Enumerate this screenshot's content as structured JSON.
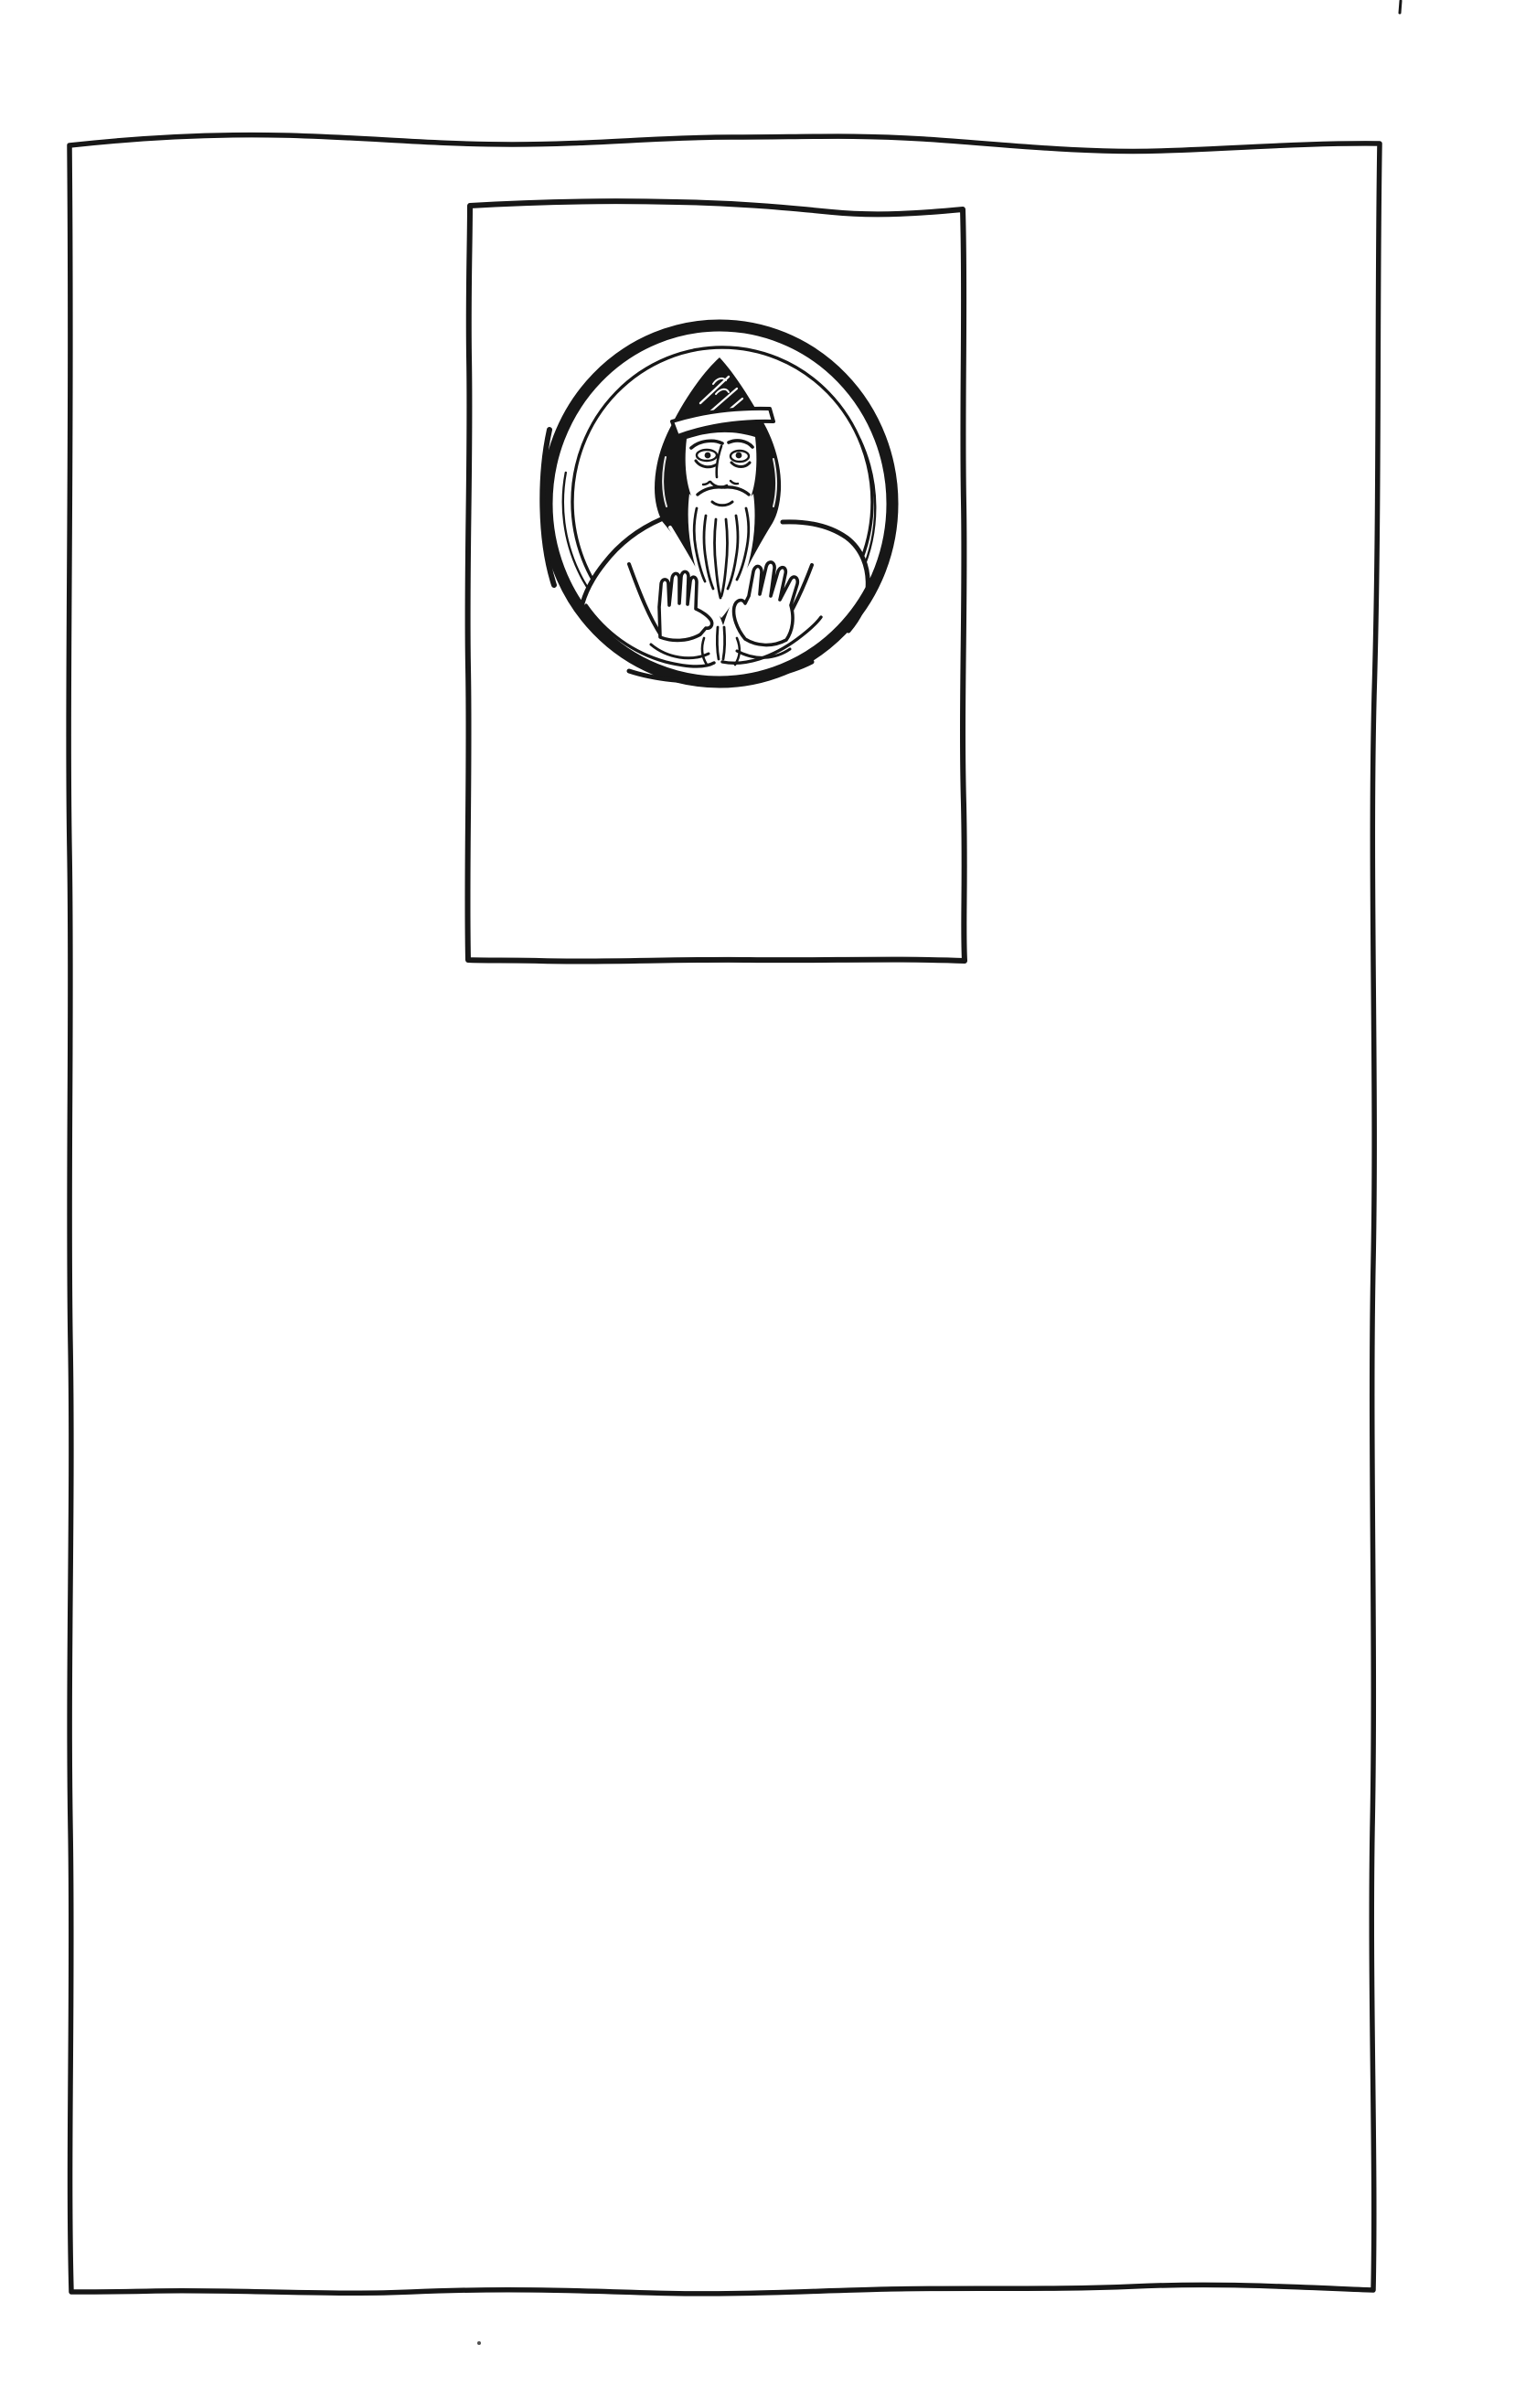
{
  "document": {
    "type": "scanned hand-inked book plate",
    "visible_text": "",
    "description": "Hand-inked page: a large wobbly rectangular border drawn around the whole sheet; in the upper middle an inner hand-drawn rectangular panel contains a double-ringed circular medallion portrait of a bearded man wearing a pointed hood, both palms raised outward."
  },
  "colors": {
    "ink": "#171717",
    "paper": "#ffffff"
  },
  "frame": {
    "outer_border": "hand-drawn wobbly rectangle around full page",
    "plate_panel": "hand-drawn rectangle in upper middle of page"
  },
  "medallion": {
    "subject": "Bearded man in pointed hood with raised palms",
    "ring_count": 2,
    "style": "medieval manuscript line drawing"
  },
  "stray_marks": {
    "top_edge_tick": "short vertical pen tick at top edge of page",
    "bottom_dot": "tiny ink speck below bottom border"
  }
}
